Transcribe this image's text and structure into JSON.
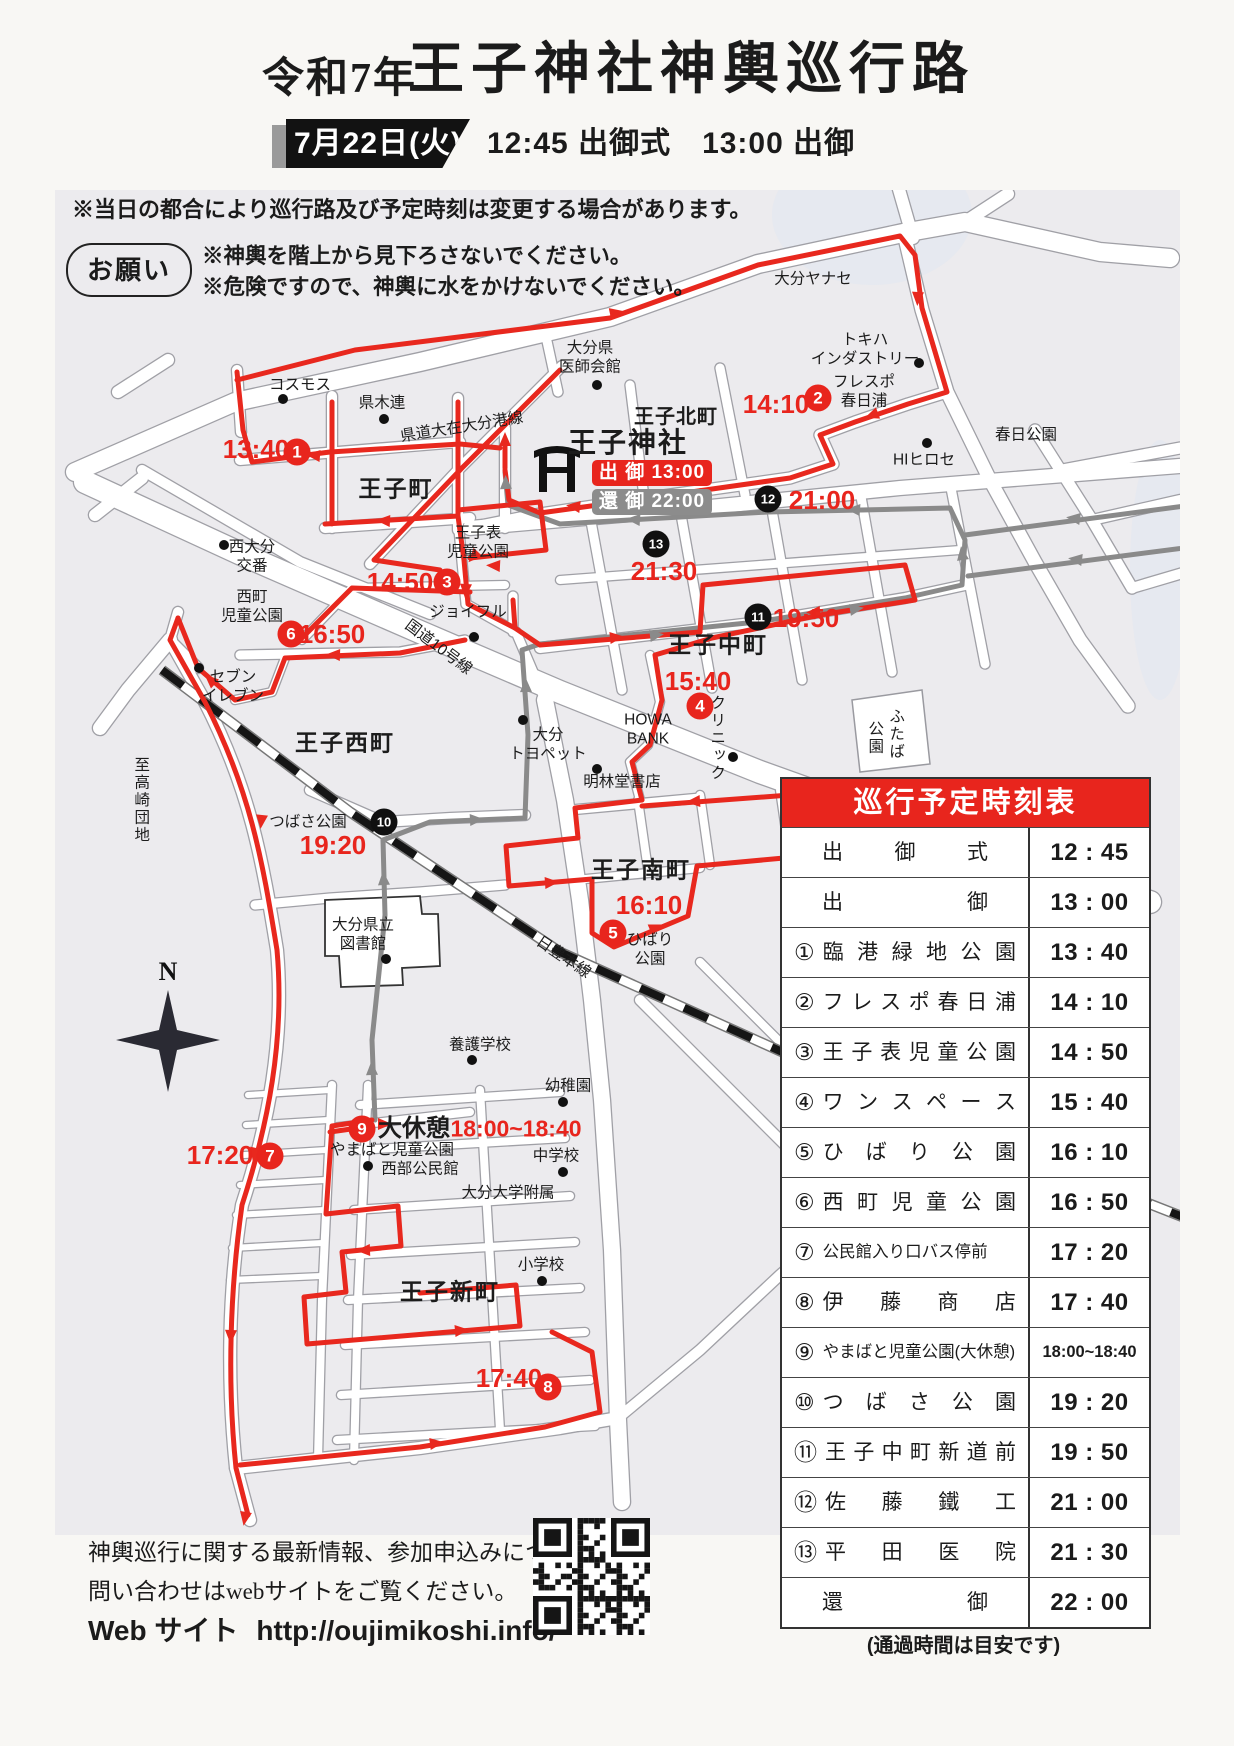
{
  "header": {
    "era": "令和7年",
    "title": "王子神社神輿巡行路",
    "date": "7月22日(火)",
    "schedule": "12:45 出御式　13:00 出御"
  },
  "notices": {
    "main": "※当日の都合により巡行路及び予定時刻は変更する場合があります。",
    "request_label": "お願い",
    "request_lines": [
      "※神輿を階上から見下ろさないでください。",
      "※危険ですので、神輿に水をかけないでください。"
    ]
  },
  "map": {
    "shrine_name": "王子神社",
    "depart_badge": "出 御 13:00",
    "return_badge": "還 御 22:00",
    "compass_n": "N",
    "labels": [
      {
        "t": "コスモス",
        "x": 300,
        "y": 386,
        "c": ""
      },
      {
        "t": "県木連",
        "x": 382,
        "y": 404,
        "c": ""
      },
      {
        "t": "県道大在大分港線",
        "x": 462,
        "y": 428,
        "c": "",
        "r": -9
      },
      {
        "t": "大分ヤナセ",
        "x": 813,
        "y": 280,
        "c": ""
      },
      {
        "t": "トキハ\nインダストリー",
        "x": 865,
        "y": 350,
        "c": ""
      },
      {
        "t": "フレスポ\n春日浦",
        "x": 864,
        "y": 392,
        "c": ""
      },
      {
        "t": "春日公園",
        "x": 1026,
        "y": 436,
        "c": ""
      },
      {
        "t": "HIヒロセ",
        "x": 924,
        "y": 461,
        "c": ""
      },
      {
        "t": "大分県\n医師会館",
        "x": 590,
        "y": 358,
        "c": ""
      },
      {
        "t": "王子北町",
        "x": 676,
        "y": 417,
        "c": "srfsm"
      },
      {
        "t": "王子町",
        "x": 396,
        "y": 489,
        "c": "srf"
      },
      {
        "t": "西大分\n交番",
        "x": 252,
        "y": 557,
        "c": ""
      },
      {
        "t": "王子表\n児童公園",
        "x": 478,
        "y": 543,
        "c": ""
      },
      {
        "t": "西町\n児童公園",
        "x": 252,
        "y": 607,
        "c": ""
      },
      {
        "t": "ジョイフル",
        "x": 468,
        "y": 613,
        "c": ""
      },
      {
        "t": "国道10号線",
        "x": 438,
        "y": 648,
        "c": "",
        "r": 37
      },
      {
        "t": "セブン\nイレブン",
        "x": 233,
        "y": 687,
        "c": ""
      },
      {
        "t": "王子西町",
        "x": 345,
        "y": 743,
        "c": "srf"
      },
      {
        "t": "大分\nトヨペット",
        "x": 548,
        "y": 745,
        "c": ""
      },
      {
        "t": "明林堂書店",
        "x": 622,
        "y": 783,
        "c": ""
      },
      {
        "t": "HOWA\nBANK",
        "x": 648,
        "y": 730,
        "c": ""
      },
      {
        "t": "王子中町",
        "x": 718,
        "y": 645,
        "c": "srf"
      },
      {
        "t": "クリニック",
        "x": 716,
        "y": 738,
        "c": "v"
      },
      {
        "t": "ふたば",
        "x": 895,
        "y": 734,
        "c": "v"
      },
      {
        "t": "公園",
        "x": 874,
        "y": 738,
        "c": "v"
      },
      {
        "t": "つばさ公園",
        "x": 308,
        "y": 823,
        "c": ""
      },
      {
        "t": "大分県立\n図書館",
        "x": 363,
        "y": 935,
        "c": ""
      },
      {
        "t": "王子南町",
        "x": 641,
        "y": 870,
        "c": "srf"
      },
      {
        "t": "ひばり\n公園",
        "x": 650,
        "y": 950,
        "c": ""
      },
      {
        "t": "日豊本線",
        "x": 563,
        "y": 958,
        "c": "",
        "r": 34
      },
      {
        "t": "養護学校",
        "x": 480,
        "y": 1046,
        "c": ""
      },
      {
        "t": "幼稚園",
        "x": 568,
        "y": 1087,
        "c": ""
      },
      {
        "t": "やまばと児童公園",
        "x": 392,
        "y": 1151,
        "c": ""
      },
      {
        "t": "西部公民館",
        "x": 420,
        "y": 1170,
        "c": ""
      },
      {
        "t": "中学校",
        "x": 556,
        "y": 1157,
        "c": ""
      },
      {
        "t": "大分大学附属",
        "x": 508,
        "y": 1194,
        "c": ""
      },
      {
        "t": "小学校",
        "x": 541,
        "y": 1266,
        "c": ""
      },
      {
        "t": "王子新町",
        "x": 450,
        "y": 1292,
        "c": "srf"
      },
      {
        "t": "至高崎団地",
        "x": 140,
        "y": 800,
        "c": "v"
      },
      {
        "t": "大休憩",
        "x": 414,
        "y": 1129,
        "c": "blk"
      },
      {
        "t": "13:40",
        "x": 256,
        "y": 449,
        "c": "red"
      },
      {
        "t": "14:10",
        "x": 776,
        "y": 404,
        "c": "red"
      },
      {
        "t": "14:50",
        "x": 400,
        "y": 582,
        "c": "red"
      },
      {
        "t": "15:40",
        "x": 698,
        "y": 681,
        "c": "red"
      },
      {
        "t": "16:10",
        "x": 649,
        "y": 905,
        "c": "red"
      },
      {
        "t": "16:50",
        "x": 332,
        "y": 634,
        "c": "red"
      },
      {
        "t": "17:20",
        "x": 220,
        "y": 1155,
        "c": "red"
      },
      {
        "t": "17:40",
        "x": 509,
        "y": 1378,
        "c": "red"
      },
      {
        "t": "18:00~18:40",
        "x": 516,
        "y": 1129,
        "c": "redsm"
      },
      {
        "t": "19:20",
        "x": 333,
        "y": 845,
        "c": "red"
      },
      {
        "t": "19:50",
        "x": 806,
        "y": 618,
        "c": "red"
      },
      {
        "t": "21:00",
        "x": 822,
        "y": 500,
        "c": "red"
      },
      {
        "t": "21:30",
        "x": 664,
        "y": 571,
        "c": "red"
      }
    ],
    "dots": [
      [
        283,
        399
      ],
      [
        384,
        419
      ],
      [
        919,
        363
      ],
      [
        927,
        443
      ],
      [
        597,
        385
      ],
      [
        224,
        545
      ],
      [
        474,
        637
      ],
      [
        199,
        668
      ],
      [
        523,
        720
      ],
      [
        597,
        769
      ],
      [
        733,
        757
      ],
      [
        386,
        959
      ],
      [
        472,
        1060
      ],
      [
        563,
        1102
      ],
      [
        368,
        1166
      ],
      [
        563,
        1172
      ],
      [
        542,
        1281
      ]
    ],
    "stops": [
      {
        "n": "1",
        "x": 297,
        "y": 452,
        "k": "r"
      },
      {
        "n": "2",
        "x": 818,
        "y": 398,
        "k": "r"
      },
      {
        "n": "3",
        "x": 447,
        "y": 582,
        "k": "r"
      },
      {
        "n": "4",
        "x": 700,
        "y": 706,
        "k": "r"
      },
      {
        "n": "5",
        "x": 613,
        "y": 933,
        "k": "r"
      },
      {
        "n": "6",
        "x": 291,
        "y": 634,
        "k": "r"
      },
      {
        "n": "7",
        "x": 270,
        "y": 1156,
        "k": "r"
      },
      {
        "n": "8",
        "x": 548,
        "y": 1387,
        "k": "r"
      },
      {
        "n": "9",
        "x": 362,
        "y": 1129,
        "k": "r"
      },
      {
        "n": "10",
        "x": 384,
        "y": 822,
        "k": "b"
      },
      {
        "n": "11",
        "x": 758,
        "y": 617,
        "k": "b"
      },
      {
        "n": "12",
        "x": 768,
        "y": 499,
        "k": "b"
      },
      {
        "n": "13",
        "x": 656,
        "y": 544,
        "k": "b"
      }
    ]
  },
  "table": {
    "title": "巡行予定時刻表",
    "rows": [
      {
        "no": "",
        "name": "出御式",
        "time": "12:45"
      },
      {
        "no": "",
        "name": "出御",
        "time": "13:00"
      },
      {
        "no": "①",
        "name": "臨港緑地公園",
        "time": "13:40"
      },
      {
        "no": "②",
        "name": "フレスポ春日浦",
        "time": "14:10"
      },
      {
        "no": "③",
        "name": "王子表児童公園",
        "time": "14:50"
      },
      {
        "no": "④",
        "name": "ワンスペース",
        "time": "15:40"
      },
      {
        "no": "⑤",
        "name": "ひばり公園",
        "time": "16:10"
      },
      {
        "no": "⑥",
        "name": "西町児童公園",
        "time": "16:50"
      },
      {
        "no": "⑦",
        "name": "公民館入り口バス停前",
        "time": "17:20"
      },
      {
        "no": "⑧",
        "name": "伊藤商店",
        "time": "17:40"
      },
      {
        "no": "⑨",
        "name": "やまばと児童公園(大休憩)",
        "time": "18:00~18:40"
      },
      {
        "no": "⑩",
        "name": "つばさ公園",
        "time": "19:20"
      },
      {
        "no": "⑪",
        "name": "王子中町新道前",
        "time": "19:50"
      },
      {
        "no": "⑫",
        "name": "佐藤鐵工",
        "time": "21:00"
      },
      {
        "no": "⑬",
        "name": "平田医院",
        "time": "21:30"
      },
      {
        "no": "",
        "name": "還御",
        "time": "22:00"
      }
    ],
    "footnote": "(通過時間は目安です)"
  },
  "footer": {
    "line1": "神輿巡行に関する最新情報、参加申込みについて、",
    "line2": "問い合わせはwebサイトをご覧ください。",
    "web_label": "Web サイト",
    "url": "http://oujimikoshi.info/"
  },
  "colors": {
    "accent": "#e8251d",
    "route_day": "#e8281e",
    "route_night": "#8a8a8a",
    "map_bg": "#ecebee",
    "banner_black": "#121212"
  }
}
